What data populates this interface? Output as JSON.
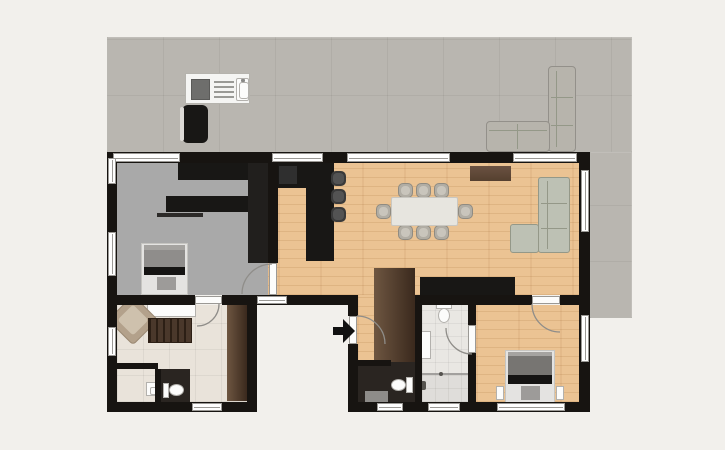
{
  "meta": {
    "type": "floor-plan",
    "description": "Top-down 2D architectural floor plan of a single-storey home with a large wrap-around terrace, open living-dining-kitchen area, two bedrooms, bathroom and two WCs",
    "canvas": {
      "width": 725,
      "height": 450
    },
    "entrance_indicator": "black arrow pointing right at entry door on the recessed south courtyard"
  },
  "colors": {
    "bg": "#f2f0ec",
    "terrace": "#b9b6b0",
    "terrace_line": "rgba(0,0,0,0.05)",
    "wall": "#171411",
    "wood": "#ebc393",
    "wood_streak": "rgba(155,100,45,0.16)",
    "wood_joint": "rgba(155,100,45,0.09)",
    "gray_floor": "#a9a9a9",
    "beige_floor": "#e9e3da",
    "beige_line": "rgba(0,0,0,0.05)",
    "bath_floor": "#e9e7e3",
    "bath_line": "rgba(0,0,0,0.05)",
    "dark_floor": "#2a2521",
    "window_fill": "#ffffff",
    "window_frame": "#9b9995",
    "door_leaf": "#fcfcfb",
    "arc": "#8f8d89",
    "black_furniture": "#181715",
    "counter_inset": "#2f2f2f",
    "wardrobe_light": "#6e5641",
    "wardrobe_dark": "#3a291d",
    "sofa": "#bdc1b4",
    "sofa_border": "#949888",
    "outdoor_sofa": "#b7b4ac",
    "outdoor_sofa_border": "#93908a",
    "chair": "#b1ada4",
    "chair_border": "#8f8b82",
    "chair_seat": "#c9c5bc",
    "stool": "#3a3a3a",
    "stool_seat": "#535353",
    "table": "#e7e5df",
    "table_border": "#c9c7c1",
    "armchair": "#b3a18b",
    "armchair_border": "#9a8872",
    "armchair_cushion": "#cec1ad",
    "dresser": "#4a382b",
    "dresser_slat": "#2c1f15",
    "bed_base": "#e4e3e1",
    "bed_border": "#c6c5c1",
    "duvet_small": "#8f8d8b",
    "duvet_main": "#777572",
    "duvet_edge": "#a5a3a0",
    "bed_black": "#151413",
    "bed_pad": "#9d9b99",
    "fixture": "#fcfcfb",
    "fixture_border": "#b3b1ad",
    "grill_body": "#f5f5f3",
    "grill_border": "#b5b3ad",
    "grill_dark": "#6e6e6c",
    "mat": "#8e8c89",
    "shower": "#8b8987",
    "arrow": "#111111"
  },
  "areas": [
    {
      "id": "terrace",
      "label_semantic": "outdoor terrace wrapping top and right of house",
      "floor": "stone-tile-gray"
    },
    {
      "id": "room-top-left",
      "label_semantic": "bedroom / office with bed, desk and wardrobes",
      "floor": "gray"
    },
    {
      "id": "living-dining-kitchen",
      "label_semantic": "open plan kitchen, dining and living room",
      "floor": "wood"
    },
    {
      "id": "room-bottom-left",
      "label_semantic": "second bedroom / lounge with armchair, dresser and en-suite WC",
      "floor": "beige-tile"
    },
    {
      "id": "hallway",
      "label_semantic": "entry hallway with wardrobe",
      "floor": "wood"
    },
    {
      "id": "wc-hall",
      "label_semantic": "guest WC off hallway",
      "floor": "dark"
    },
    {
      "id": "bathroom",
      "label_semantic": "bathroom with toilet, vanity and shower",
      "floor": "white-tile"
    },
    {
      "id": "bedroom-bottom-right",
      "label_semantic": "main bedroom with double bed and nightstands",
      "floor": "wood"
    }
  ],
  "furniture": [
    "outdoor-grill-unit-with-sink",
    "outdoor-black-barrel",
    "outdoor-corner-sofa",
    "wardrobe-top",
    "wardrobe-side",
    "desk-with-shelf",
    "single-bed",
    "kitchen-counter",
    "kitchen-island",
    "bar-stools-x3",
    "dining-table",
    "dining-chairs-x8",
    "top-sideboard-brown",
    "corner-sofa-living",
    "tv-lowboard-black",
    "hall-wardrobe",
    "toilet-hall-wc",
    "bath-mat",
    "toilet-bathroom",
    "vanity-sink",
    "shower-partition",
    "double-bed",
    "nightstand-left",
    "nightstand-right",
    "console-white",
    "armchair",
    "dresser-slatted",
    "wardrobe-beige-room",
    "small-sink",
    "toilet-beige-wc"
  ],
  "openings": {
    "windows_count": 14,
    "interior_doors_count": 5,
    "entry_door_count": 1
  }
}
